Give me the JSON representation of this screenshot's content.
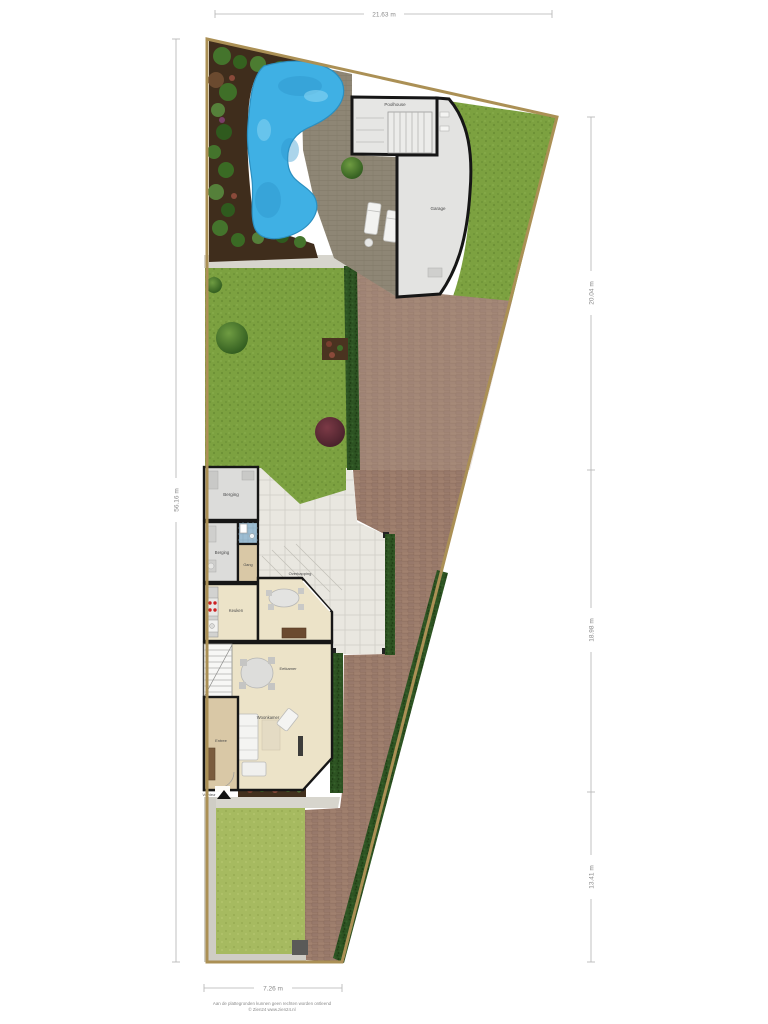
{
  "dimensions": {
    "top": "21.63 m",
    "left": "56.16 m",
    "right_top": "20.04 m",
    "right_middle": "18.98 m",
    "right_bottom": "13.41 m",
    "bottom": "7.26 m"
  },
  "labels": {
    "poolhouse": "Poolhouse",
    "garage": "Garage",
    "berging_top": "Berging",
    "berging_side": "Berging",
    "hall": "Gang",
    "kitchen": "Keuken",
    "canopy": "Overkapping",
    "dining": "Eetkamer",
    "living": "Woonkamer",
    "entry": "Entree",
    "front_door": "Voordeur"
  },
  "footer": {
    "disclaimer": "Aan de plattegronden kunnen geen rechten worden ontleend",
    "copyright": "© Zien24 www.zien24.nl"
  },
  "colors": {
    "boundary": "#ab9055",
    "lawn": "#7ca140",
    "lawn_front": "#a6ba60",
    "pool_water": "#3fb0e4",
    "soil_bed": "#3f2d1c",
    "brick_paving": "#9c7d6c",
    "hedge": "#2d5322",
    "deck": "#8e8675",
    "building_floor": "#e4e4e2",
    "house_floor": "#ece3c8",
    "wall": "#161616",
    "terrace_tile": "#e9e7e0"
  }
}
